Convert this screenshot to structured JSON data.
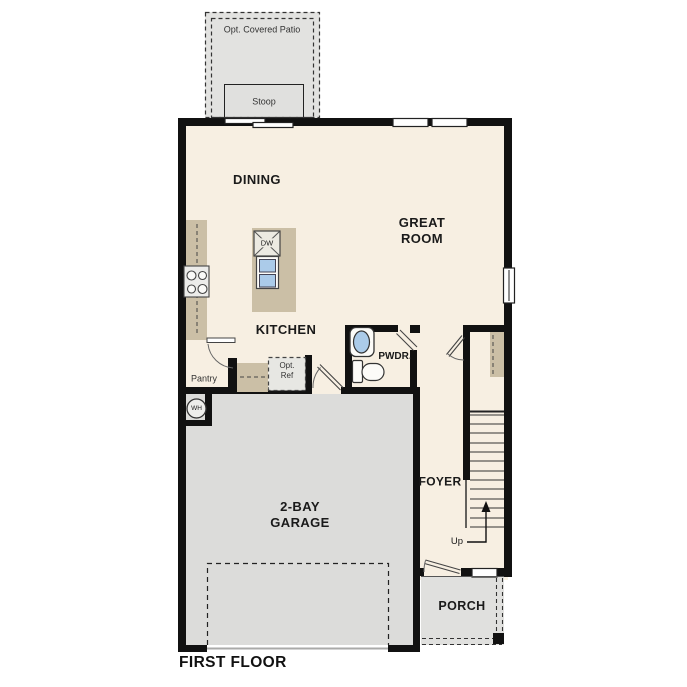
{
  "title": "FIRST FLOOR",
  "rooms": {
    "dining": "DINING",
    "great_room": "GREAT\nROOM",
    "kitchen": "KITCHEN",
    "pwdr": "PWDR.",
    "foyer": "FOYER",
    "garage": "2-BAY\nGARAGE",
    "porch": "PORCH",
    "pantry": "Pantry"
  },
  "outdoor": {
    "patio": "Opt. Covered Patio",
    "stoop": "Stoop"
  },
  "fixtures": {
    "dishwasher": "DW",
    "water_heater": "WH",
    "opt_ref": "Opt.\nRef",
    "stairs_up": "Up"
  },
  "colors": {
    "wall": "#111111",
    "interior_floor": "#f7efe2",
    "garage_floor": "#dcdcda",
    "outdoor_gray": "#e2e2e0",
    "counter_tan": "#cbbfa6",
    "sink_blue": "#abcbe9",
    "text": "#1a1a1a"
  }
}
